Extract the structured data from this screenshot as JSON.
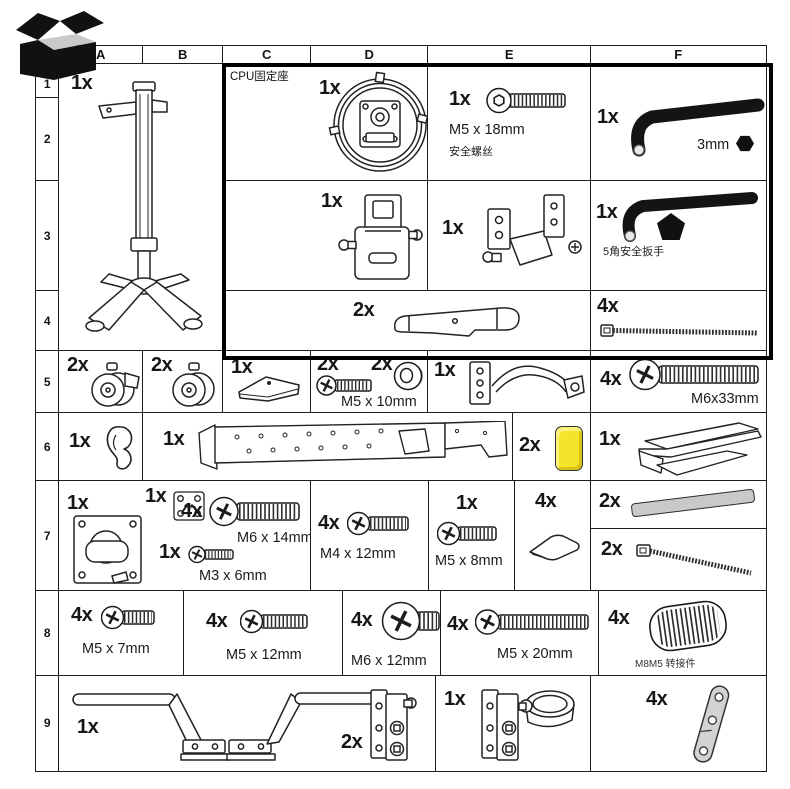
{
  "columns": [
    "A",
    "B",
    "C",
    "D",
    "E",
    "F"
  ],
  "row_numbers": [
    "1",
    "2",
    "3",
    "4",
    "5",
    "6",
    "7",
    "8",
    "9"
  ],
  "colors": {
    "highlight_yellow": "#f3e42c",
    "part_gray": "#c9c9c9",
    "line_black": "#1c1c1c"
  },
  "parts": {
    "monitor_stand": {
      "qty": "1x"
    },
    "cpu_holder_label": "CPU固定座",
    "cpu_holder": {
      "qty": "1x"
    },
    "safety_screw": {
      "qty": "1x",
      "size": "M5 x 18mm",
      "note": "安全螺丝"
    },
    "hex_key_3mm": {
      "qty": "1x",
      "size": "3mm"
    },
    "cpu_bracket": {
      "qty": "1x"
    },
    "corner_bracket": {
      "qty": "1x"
    },
    "security_wrench": {
      "qty": "1x",
      "note": "5角安全扳手"
    },
    "handle_bar": {
      "qty": "2x"
    },
    "cable_tie_long": {
      "qty": "4x"
    },
    "caster_locking": {
      "qty": "2x"
    },
    "caster": {
      "qty": "2x"
    },
    "cover_cap": {
      "qty": "1x"
    },
    "screw_m5x10": {
      "qty_screw": "2x",
      "qty_washer": "2x",
      "size": "M5 x 10mm"
    },
    "headset_hook": {
      "qty": "1x"
    },
    "screw_m6x33": {
      "qty": "4x",
      "size": "M6x33mm"
    },
    "cable_clip": {
      "qty": "1x"
    },
    "support_rail": {
      "qty": "1x"
    },
    "yellow_spacer": {
      "qty": "2x"
    },
    "tilt_bracket": {
      "qty": "1x"
    },
    "vesa_plate": {
      "qty": "1x"
    },
    "adapter_plate": {
      "qty": "1x"
    },
    "screw_m6x14": {
      "qty": "4x",
      "size": "M6 x 14mm"
    },
    "screw_m3x6": {
      "qty": "1x",
      "size": "M3 x 6mm"
    },
    "screw_m4x12": {
      "qty": "4x",
      "size": "M4 x 12mm"
    },
    "screw_m5x8": {
      "qty": "1x",
      "size": "M5 x 8mm"
    },
    "glide_pad": {
      "qty": "4x"
    },
    "foam_strip": {
      "qty": "2x"
    },
    "cable_tie_short": {
      "qty": "2x"
    },
    "screw_m5x7": {
      "qty": "4x",
      "size": "M5 x 7mm"
    },
    "screw_m5x12": {
      "qty": "4x",
      "size": "M5 x 12mm"
    },
    "screw_m6x12": {
      "qty": "4x",
      "size": "M6 x 12mm"
    },
    "screw_m5x20": {
      "qty": "4x",
      "size": "M5 x 20mm"
    },
    "thread_adapter": {
      "qty": "4x",
      "size": "M8M5 转接件"
    },
    "crossbar_frame": {
      "qty": "1x"
    },
    "clamp_plates": {
      "qty": "2x"
    },
    "pole_clamp": {
      "qty": "1x"
    },
    "link_strap": {
      "qty": "4x"
    }
  }
}
